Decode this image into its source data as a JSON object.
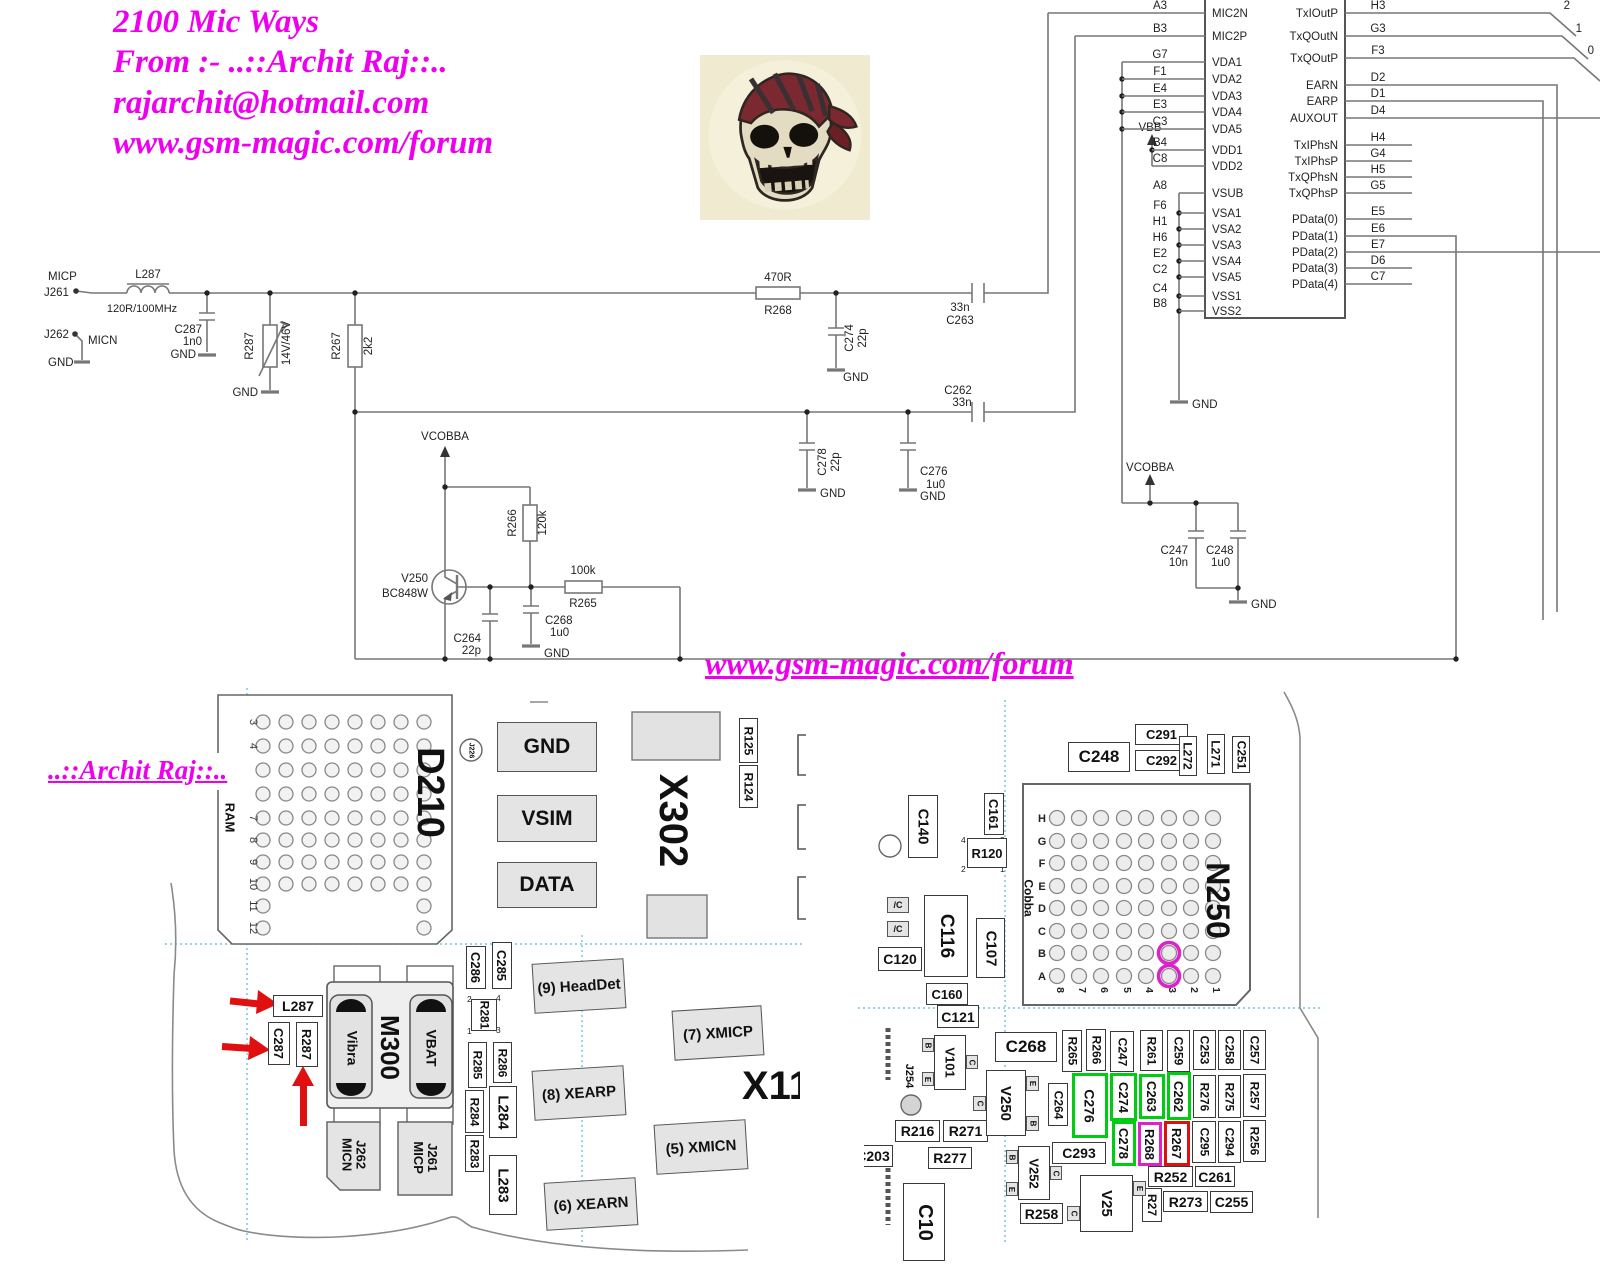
{
  "title_block": {
    "line1": "2100 Mic Ways",
    "line2": "From :- ..::Archit Raj::..",
    "line3": "rajarchit@hotmail.com",
    "line4": "www.gsm-magic.com/forum"
  },
  "watermark": "www.gsm-magic.com/forum",
  "signature": "..::Archit Raj::..",
  "colors": {
    "magenta_text": "#ee00ee",
    "wire": "#777777",
    "highlight_green": "#00cc11",
    "highlight_magenta": "#dd22cc",
    "highlight_red": "#e01010",
    "arrow_red": "#e01010",
    "guide_cyan": "#58b8d8"
  },
  "schematic": {
    "nets": {
      "micp": "MICP",
      "micn": "MICN",
      "j261": "J261",
      "j262": "J262",
      "gnd": "GND",
      "vbb": "VBB",
      "vcobba": "VCOBBA"
    },
    "components": {
      "L287": {
        "ref": "L287",
        "value": "120R/100MHz"
      },
      "C287": {
        "ref": "C287",
        "value": "1n0"
      },
      "R287": {
        "ref": "R287",
        "value": "14V/46V"
      },
      "R267": {
        "ref": "R267",
        "value": "2k2"
      },
      "R268": {
        "ref": "R268",
        "value": "470R"
      },
      "C274": {
        "ref": "C274",
        "value": "22p"
      },
      "C263": {
        "ref": "C263",
        "value": "33n"
      },
      "C262": {
        "ref": "C262",
        "value": "33n"
      },
      "C278": {
        "ref": "C278",
        "value": "22p"
      },
      "C276": {
        "ref": "C276",
        "value": "1u0"
      },
      "R266": {
        "ref": "R266",
        "value": "120k"
      },
      "R265": {
        "ref": "R265",
        "value": "100k"
      },
      "C264": {
        "ref": "C264",
        "value": "22p"
      },
      "C268": {
        "ref": "C268",
        "value": "1u0"
      },
      "V250": {
        "ref": "V250",
        "value": "BC848W"
      },
      "C247": {
        "ref": "C247",
        "value": "10n"
      },
      "C248": {
        "ref": "C248",
        "value": "1u0"
      }
    },
    "ic": {
      "left_pins": [
        {
          "pin": "A3",
          "name": "MIC2N"
        },
        {
          "pin": "B3",
          "name": "MIC2P"
        },
        {
          "pin": "G7",
          "name": "VDA1"
        },
        {
          "pin": "F1",
          "name": "VDA2"
        },
        {
          "pin": "E4",
          "name": "VDA3"
        },
        {
          "pin": "E3",
          "name": "VDA4"
        },
        {
          "pin": "C3",
          "name": "VDA5"
        },
        {
          "pin": "B4",
          "name": "VDD1"
        },
        {
          "pin": "C8",
          "name": "VDD2"
        },
        {
          "pin": "A8",
          "name": "VSUB"
        },
        {
          "pin": "F6",
          "name": "VSA1"
        },
        {
          "pin": "H1",
          "name": "VSA2"
        },
        {
          "pin": "H6",
          "name": "VSA3"
        },
        {
          "pin": "E2",
          "name": "VSA4"
        },
        {
          "pin": "C2",
          "name": "VSA5"
        },
        {
          "pin": "C4",
          "name": "VSS1"
        },
        {
          "pin": "B8",
          "name": "VSS2"
        }
      ],
      "right_pins": [
        {
          "pin": "H3",
          "name": "TxIOutP"
        },
        {
          "pin": "G3",
          "name": "TxQOutN"
        },
        {
          "pin": "F3",
          "name": "TxQOutP"
        },
        {
          "pin": "D2",
          "name": "EARN"
        },
        {
          "pin": "D1",
          "name": "EARP"
        },
        {
          "pin": "D4",
          "name": "AUXOUT"
        },
        {
          "pin": "H4",
          "name": "TxIPhsN"
        },
        {
          "pin": "G4",
          "name": "TxIPhsP"
        },
        {
          "pin": "H5",
          "name": "TxQPhsN"
        },
        {
          "pin": "G5",
          "name": "TxQPhsP"
        },
        {
          "pin": "E5",
          "name": "PData(0)"
        },
        {
          "pin": "E6",
          "name": "PData(1)"
        },
        {
          "pin": "E7",
          "name": "PData(2)"
        },
        {
          "pin": "D6",
          "name": "PData(3)"
        },
        {
          "pin": "C7",
          "name": "PData(4)"
        }
      ],
      "bus_bits": [
        "2",
        "1",
        "0"
      ]
    }
  },
  "pcb": {
    "labels": {
      "d210": "D210",
      "ram": "RAM",
      "gnd": "GND",
      "vsim": "VSIM",
      "data": "DATA",
      "j226": "J226",
      "x302": "X302",
      "r125": "R125",
      "r124": "R124",
      "l287": "L287",
      "c287": "C287",
      "r287": "R287",
      "m300": "M300",
      "vibra": "Vibra",
      "vbat": "VBAT",
      "j262": "J262",
      "micn": "MICN",
      "j261": "J261",
      "micp": "MICP",
      "c286": "C286",
      "c285": "C285",
      "r281": "R281",
      "r285": "R285",
      "r286": "R286",
      "r284": "R284",
      "r283": "R283",
      "l284": "L284",
      "l283": "L283",
      "headdet": "(9) HeadDet",
      "xearp": "(8) XEARP",
      "xearn": "(6) XEARN",
      "xmicp": "(7) XMICP",
      "xmicn": "(5) XMICN",
      "x11": "X11",
      "n250": "N250",
      "cobba": "Cobba",
      "c248": "C248",
      "c291": "C291",
      "c292": "C292",
      "l272": "L272",
      "l271": "L271",
      "c251": "C251",
      "c140": "C140",
      "c161": "C161",
      "r120": "R120",
      "nc": "/C",
      "c120": "C120",
      "c116": "C116",
      "c107": "C107",
      "c160": "C160",
      "c121": "C121",
      "v101": "V101",
      "j254": "J254",
      "r216": "R216",
      "r271": "R271",
      "r277": "R277",
      "c203": "C203",
      "c106": "C10",
      "c268": "C268",
      "v250": "V250",
      "c264": "C264",
      "c276": "C276",
      "c274": "C274",
      "c263": "C263",
      "c262": "C262",
      "c278": "C278",
      "r268": "R268",
      "r267": "R267",
      "r265": "R265",
      "r266": "R266",
      "c247": "C247",
      "r261": "R261",
      "c259": "C259",
      "c253": "C253",
      "c258": "C258",
      "c257": "C257",
      "r276": "R276",
      "r275": "R275",
      "r257": "R257",
      "c295": "C295",
      "c294": "C294",
      "r256": "R256",
      "r252": "R252",
      "c261": "C261",
      "r273": "R273",
      "c255": "C255",
      "r258": "R258",
      "r27": "R27",
      "v252": "V252",
      "v25": "V25",
      "c293": "C293",
      "pin_b": "B",
      "pin_c": "C",
      "pin_e": "E"
    },
    "d210_rows": [
      "3",
      "4",
      "7",
      "8",
      "9",
      "10",
      "11",
      "12"
    ],
    "n250": {
      "rows": [
        "H",
        "G",
        "F",
        "E",
        "D",
        "C",
        "B",
        "A"
      ],
      "cols": [
        "8",
        "7",
        "6",
        "5",
        "4",
        "3",
        "2",
        "1"
      ],
      "highlighted_balls": [
        "B3",
        "A3"
      ]
    },
    "r281_pins": [
      "2",
      "4",
      "1",
      "3"
    ],
    "r120_pins": [
      "4",
      "3",
      "2",
      "1"
    ]
  }
}
